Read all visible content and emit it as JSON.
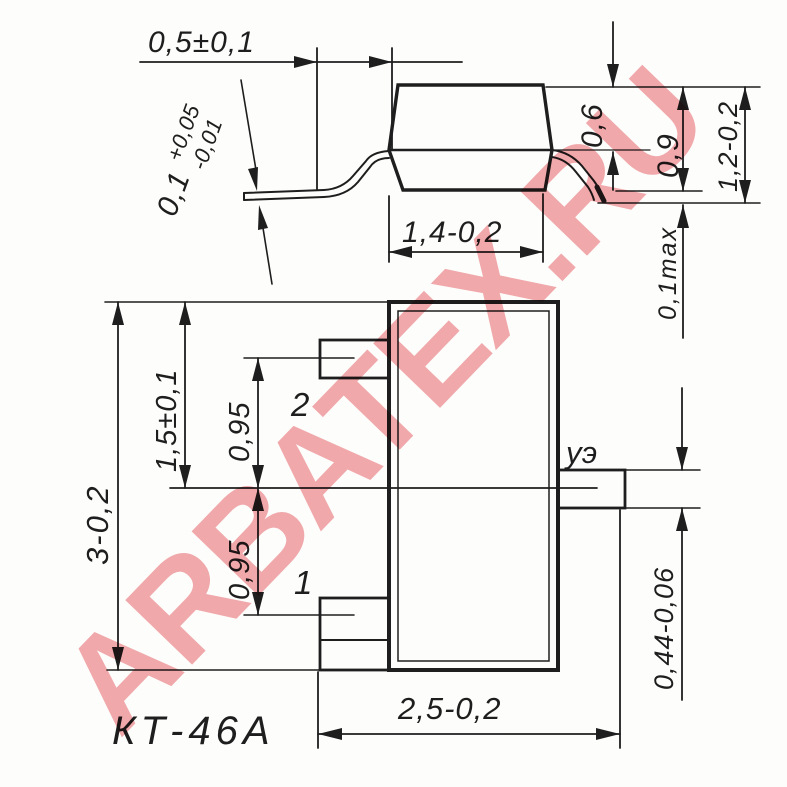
{
  "caption": "КТ-46А",
  "watermark": "ARBATEX.RU",
  "colors": {
    "ink": "#1e1e1e",
    "watermark": "rgba(220,30,40,0.38)"
  },
  "side_view": {
    "dim_lead_length": "0,5±0,1",
    "lead_thickness": {
      "base": "0,1",
      "plus": "+0,05",
      "minus": "-0,01"
    },
    "dim_body_bottom_width": "1,4-0,2",
    "dim_body_top_half": "0,6",
    "dim_body_height": "0,9",
    "dim_total_height": "1,2-0,2",
    "dim_standoff": "0,1max"
  },
  "bottom_view": {
    "dim_body_length": "3-0,2",
    "dim_half_length": "1,5±0,1",
    "dim_pitch_upper": "0,95",
    "dim_pitch_lower": "0,95",
    "dim_lead_width": "0,44-0,06",
    "dim_total_width": "2,5-0,2",
    "pin_labels": {
      "pin1": "1",
      "pin2": "2",
      "pin3": "уэ"
    }
  }
}
